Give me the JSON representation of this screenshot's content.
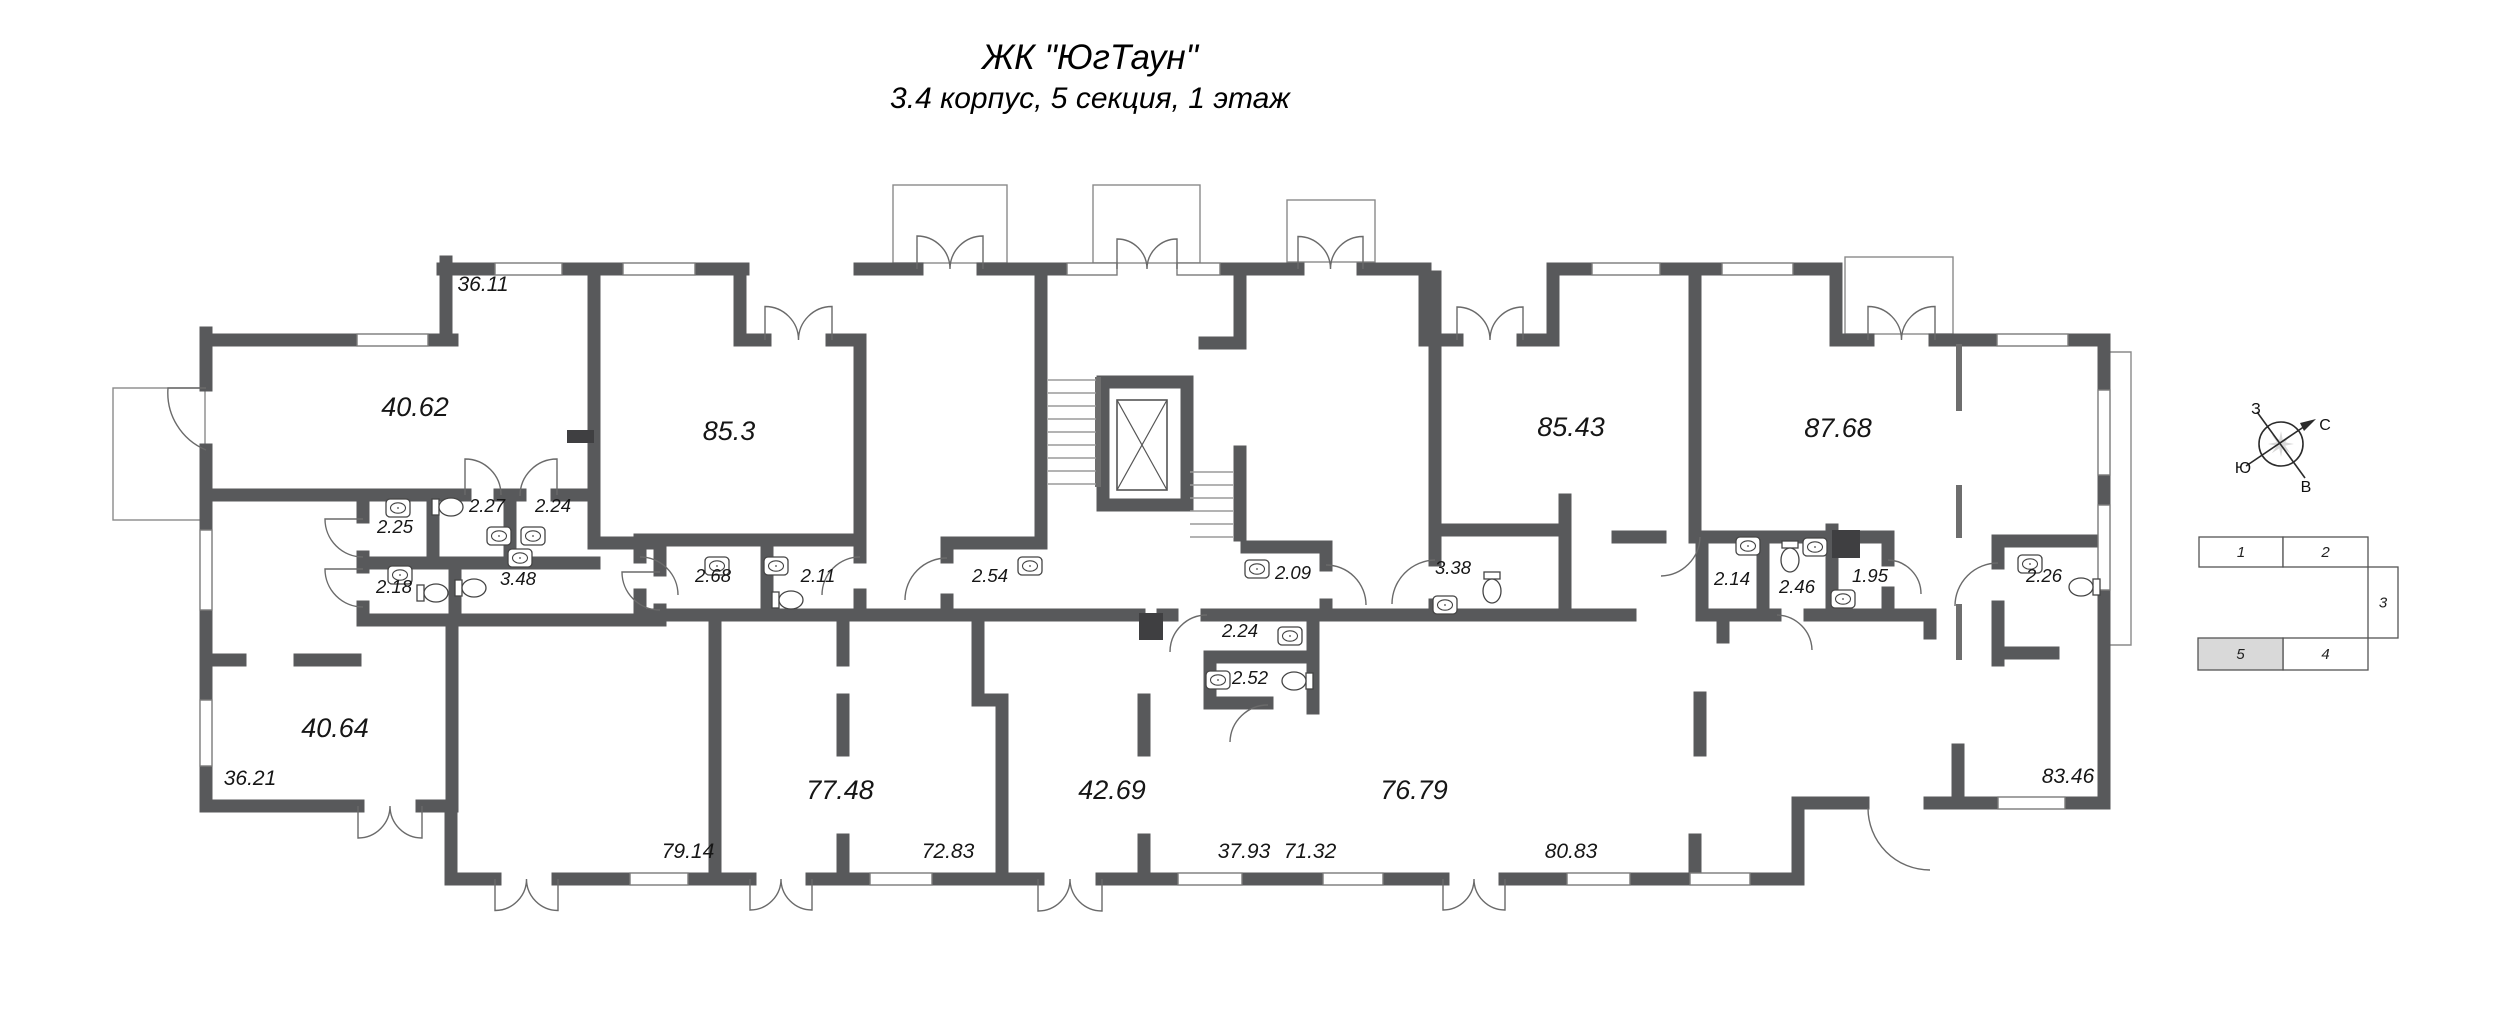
{
  "title": "ЖК \"ЮгТаун\"",
  "subtitle": "3.4 корпус, 5 секция, 1 этаж",
  "plan": {
    "room_labels": [
      {
        "text": "36.11",
        "x": 483,
        "y": 291,
        "size": "md"
      },
      {
        "text": "40.62",
        "x": 415,
        "y": 416,
        "size": "lg"
      },
      {
        "text": "85.3",
        "x": 729,
        "y": 440,
        "size": "lg"
      },
      {
        "text": "85.43",
        "x": 1571,
        "y": 436,
        "size": "lg"
      },
      {
        "text": "87.68",
        "x": 1838,
        "y": 437,
        "size": "lg"
      },
      {
        "text": "2.25",
        "x": 395,
        "y": 533,
        "size": "sm"
      },
      {
        "text": "2.27",
        "x": 487,
        "y": 512,
        "size": "sm"
      },
      {
        "text": "2.24",
        "x": 553,
        "y": 512,
        "size": "sm"
      },
      {
        "text": "2.18",
        "x": 394,
        "y": 593,
        "size": "sm"
      },
      {
        "text": "3.48",
        "x": 518,
        "y": 585,
        "size": "sm"
      },
      {
        "text": "2.68",
        "x": 713,
        "y": 582,
        "size": "sm"
      },
      {
        "text": "2.11",
        "x": 818,
        "y": 582,
        "size": "sm"
      },
      {
        "text": "2.54",
        "x": 990,
        "y": 582,
        "size": "sm"
      },
      {
        "text": "2.09",
        "x": 1293,
        "y": 579,
        "size": "sm"
      },
      {
        "text": "2.24",
        "x": 1240,
        "y": 637,
        "size": "sm"
      },
      {
        "text": "2.52",
        "x": 1250,
        "y": 684,
        "size": "sm"
      },
      {
        "text": "3.38",
        "x": 1453,
        "y": 574,
        "size": "sm"
      },
      {
        "text": "2.14",
        "x": 1732,
        "y": 585,
        "size": "sm"
      },
      {
        "text": "2.46",
        "x": 1797,
        "y": 593,
        "size": "sm"
      },
      {
        "text": "1.95",
        "x": 1870,
        "y": 582,
        "size": "sm"
      },
      {
        "text": "2.26",
        "x": 2044,
        "y": 582,
        "size": "sm"
      },
      {
        "text": "40.64",
        "x": 335,
        "y": 737,
        "size": "lg"
      },
      {
        "text": "36.21",
        "x": 250,
        "y": 785,
        "size": "md"
      },
      {
        "text": "79.14",
        "x": 688,
        "y": 858,
        "size": "md"
      },
      {
        "text": "77.48",
        "x": 840,
        "y": 799,
        "size": "lg"
      },
      {
        "text": "72.83",
        "x": 948,
        "y": 858,
        "size": "md"
      },
      {
        "text": "42.69",
        "x": 1112,
        "y": 799,
        "size": "lg"
      },
      {
        "text": "37.93",
        "x": 1244,
        "y": 858,
        "size": "md"
      },
      {
        "text": "71.32",
        "x": 1310,
        "y": 858,
        "size": "md"
      },
      {
        "text": "76.79",
        "x": 1414,
        "y": 799,
        "size": "lg"
      },
      {
        "text": "80.83",
        "x": 1571,
        "y": 858,
        "size": "md"
      },
      {
        "text": "83.46",
        "x": 2068,
        "y": 783,
        "size": "md"
      }
    ]
  },
  "compass": {
    "west": "З",
    "north": "С",
    "south": "Ю",
    "east": "В"
  },
  "section_key": {
    "sections": [
      "1",
      "2",
      "3",
      "4",
      "5"
    ],
    "current": "5",
    "highlight_color": "#d9d9d9"
  },
  "colors": {
    "wall": "#58595b",
    "thin": "#6e6e6e",
    "text": "#161616",
    "background": "#ffffff"
  }
}
